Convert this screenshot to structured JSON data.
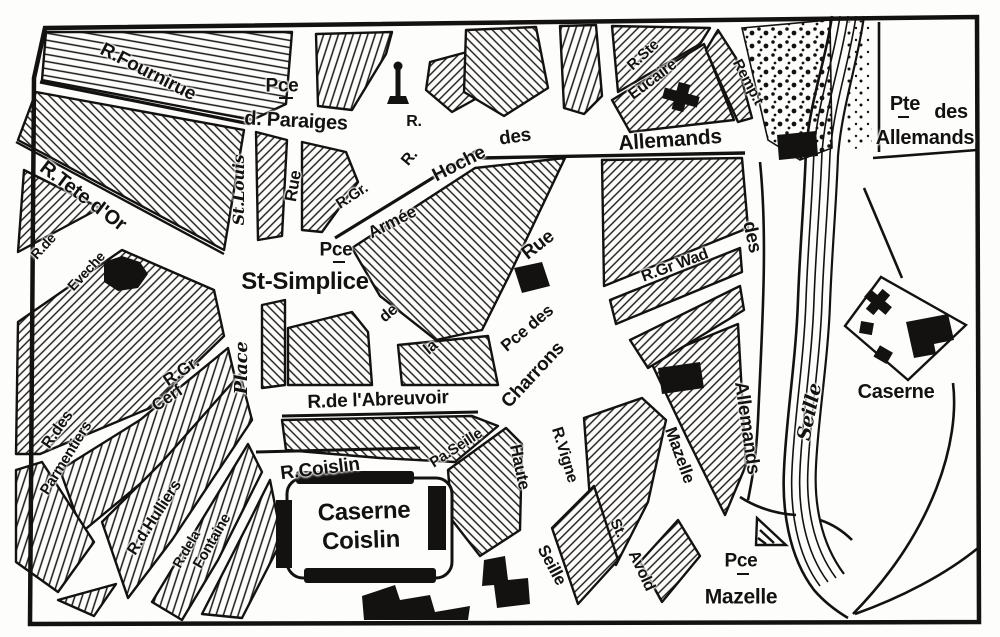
{
  "map": {
    "kind": "historic city plan (Metz, Outre-Seille quarter)",
    "colors": {
      "ink": "#141210",
      "paper": "#fdfdfb"
    },
    "symbols": {
      "church-cross-icon": "black cross (Ste-Eucaire church)",
      "monument-icon": "small obelisk/lantern mark",
      "triangle-icon": "small hatched triangle",
      "porte-gate-icon": "black gate block on bridge",
      "building-block": "solid black building footprint"
    },
    "labels": {
      "fournirue": "R.Fournirue",
      "pce_paraiges": "Pce",
      "d_paraiges": "d. Paraiges",
      "r_north_1": "R.",
      "r_north_2": "R.",
      "armee": "Armée",
      "hoche": "Hoche",
      "des_allemands": "des",
      "allemands": "Allemands",
      "r_ste": "R.Ste",
      "eucaire": "Eucaire",
      "rempart": "Remp.t",
      "pte": "Pte",
      "pte_des": "des",
      "pte_allemands": "Allemands",
      "tete_dor": "R.Tete d'Or",
      "r_de_eveche": "R.de",
      "eveche": "Eveche",
      "st_louis": "St.Louis",
      "rue_paraiges": "Rue",
      "pce_simplice": "Pce",
      "st_simplice": "St-Simplice",
      "r_gr": "R.Gr.",
      "de_fragment": "de",
      "la_fragment": "la",
      "rue_charrons": "Rue",
      "pce_des_charrons": "Pce des",
      "charrons": "Charrons",
      "gr_wad": "R.Gr Wad",
      "des_vertical": "des",
      "allemands_vertical": "Allemands",
      "place": "Place",
      "gr_cerf_1": "R.Gr.",
      "gr_cerf_2": "Cerf",
      "r_des": "R.des",
      "parmentiers": "Parmentiers",
      "hulliers": "R.d.Hulliers",
      "r_de_la": "R.dela",
      "fontaine": "Fontaine",
      "abreuvoir": "R.de l'Abreuvoir",
      "r_coislin": "R.Coislin",
      "caserne_coislin_1": "Caserne",
      "caserne_coislin_2": "Coislin",
      "pa_seille": "Pa.Seille",
      "haute": "Haute",
      "haute_seille_2": "Seille",
      "vigne": "R.Vigne",
      "st_avold_st": "St.",
      "avold": "Avold",
      "mazelle_street": "Mazelle",
      "seille_river": "Seille",
      "caserne_right": "Caserne",
      "pce_mazelle": "Pce",
      "mazelle_place": "Mazelle"
    }
  }
}
